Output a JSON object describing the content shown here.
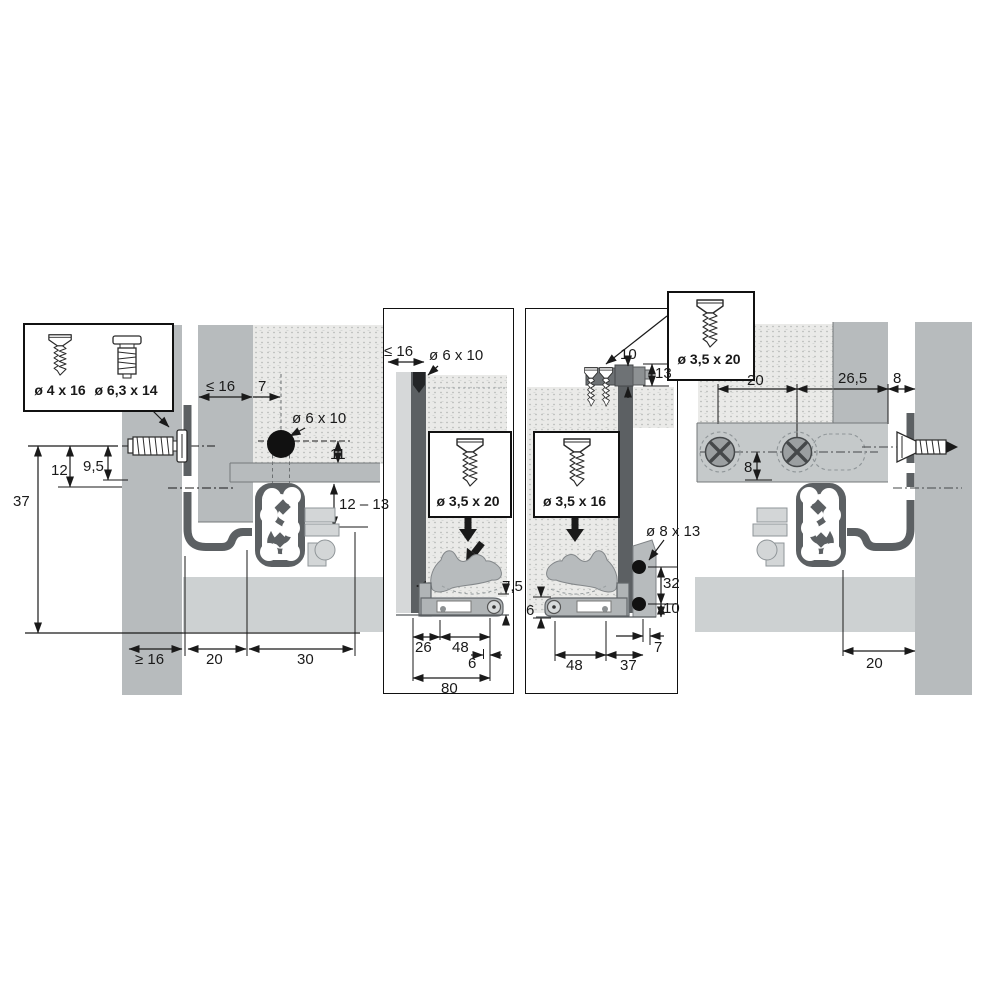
{
  "colors": {
    "panel": "#b7bbbd",
    "band": "#cdd1d2",
    "bracket": "#c5c9ca",
    "rail_dark": "#5c6063",
    "chipboard": "#eaeae8",
    "line": "#1a1a1a"
  },
  "callout_left": {
    "screw1_label": "ø 4 x 16",
    "screw2_label": "ø 6,3 x 14"
  },
  "callout_right": {
    "screw_label": "ø 3,5 x 20"
  },
  "left_section": {
    "panel_thickness": "≤ 16",
    "hole_offset": "7",
    "hole_label": "ø 6 x 10",
    "dim_11": "11",
    "dim_12": "12",
    "dim_9_5": "9,5",
    "dim_37": "37",
    "dim_12_13": "12 – 13",
    "dim_ge_16": "≥ 16",
    "dim_20": "20",
    "dim_30": "30"
  },
  "panel_left_box": {
    "panel_thickness": "≤ 16",
    "hole_label": "ø 6 x 10",
    "screw_label": "ø 3,5 x 20",
    "dim_7_5": "7,5",
    "dim_26": "26",
    "dim_48": "48",
    "dim_6": "6",
    "dim_80": "80"
  },
  "panel_right_box": {
    "dim_10_top": "10",
    "dim_13": "13",
    "screw_label": "ø 3,5 x 16",
    "pin_label": "ø 8 x 13",
    "dim_32": "32",
    "dim_10_bottom": "10",
    "dim_6": "6",
    "dim_48": "48",
    "dim_37": "37",
    "dim_7": "7"
  },
  "right_section": {
    "dim_20_top": "20",
    "dim_26_5": "26,5",
    "dim_8_gap": "8",
    "dim_8_holes": "8",
    "dim_20_bottom": "20"
  }
}
